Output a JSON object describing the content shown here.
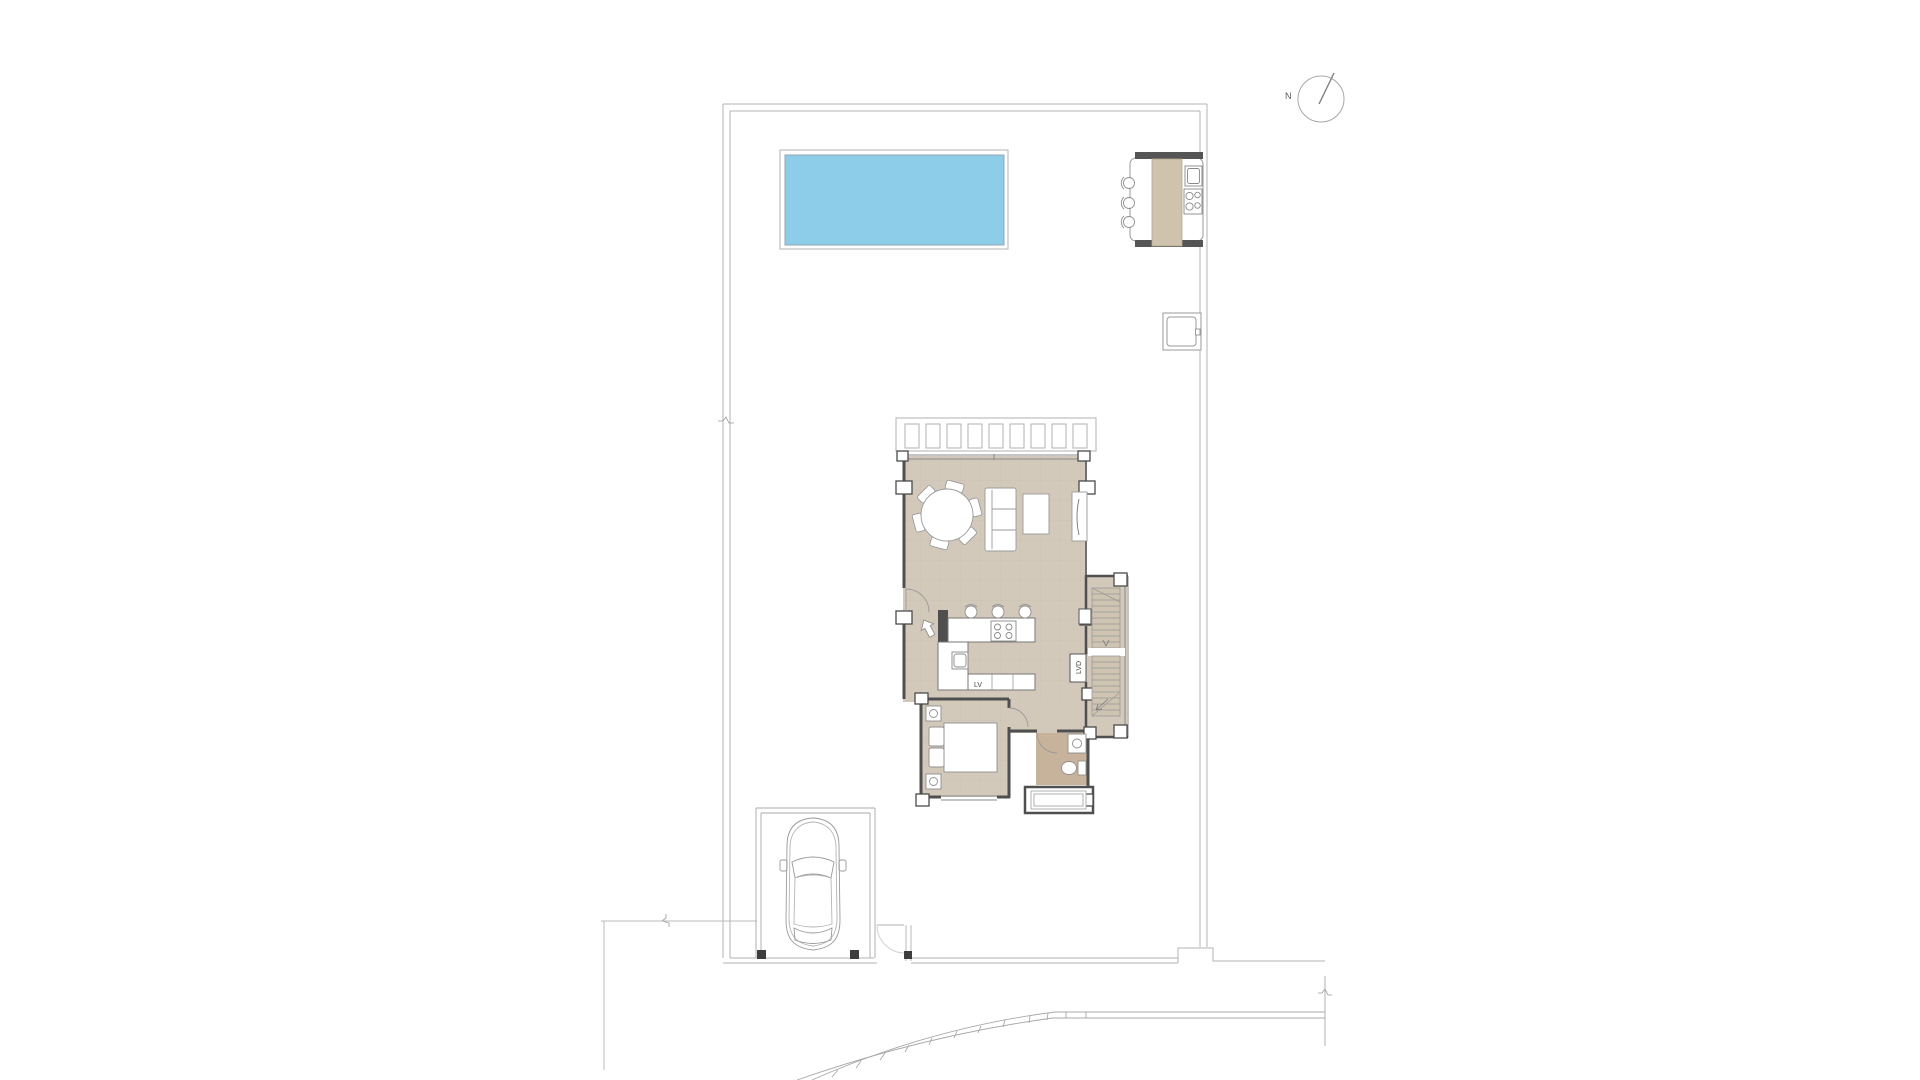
{
  "plan": {
    "compass_label": "N",
    "kitchen": {
      "dishwasher_label": "LV"
    },
    "utility": {
      "washer_label": "LVD"
    },
    "colors": {
      "pool_fill": "#8ecde9",
      "pool_stroke": "#90a8b2",
      "floor_tan": "#d3c9ba",
      "floor_tan_dark": "#c7b29c",
      "stair_tread_fill": "#cfc4b2",
      "wall_dark": "#4f4f4f",
      "furniture_line": "#8f8f8f",
      "boundary_line": "#b3b3b3",
      "counter_line": "#777777"
    }
  }
}
